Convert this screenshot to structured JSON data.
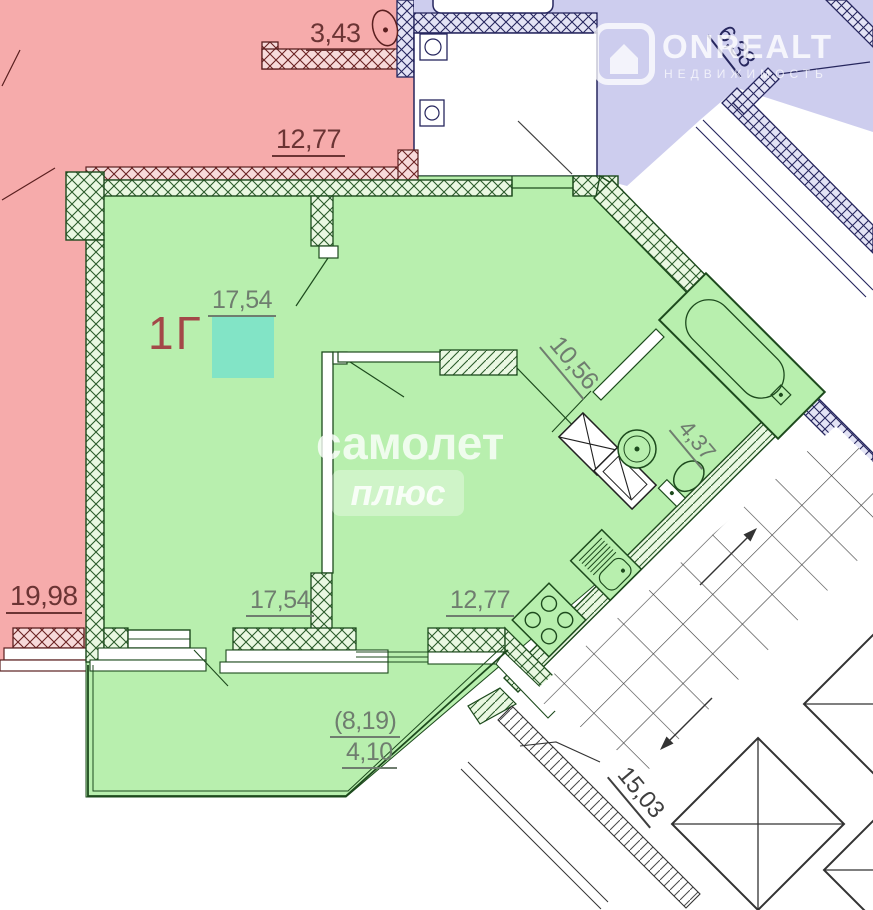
{
  "plan_type": "apartment-floor-plan",
  "unit": {
    "label": "1Г"
  },
  "dimensions": {
    "pink_bath": "3,43",
    "pink_room_top": "12,77",
    "purple_room": "6,38",
    "living_area": "17,54",
    "hallway": "10,56",
    "bathroom": "4,37",
    "pink_room_left": "19,98",
    "living_width": "17,54",
    "kitchen": "12,77",
    "balcony_full": "(8,19)",
    "balcony_reduced": "4,10",
    "stairwell": "15,03"
  },
  "watermarks": {
    "samolet": "самолет",
    "plus": "плюс",
    "onrealt": "ONREALT",
    "onrealt_subtitle": "НЕДВИЖИМОСТЬ"
  },
  "colors": {
    "unit_fill": "#b8efae",
    "neighbor_pink_fill": "#f6abab",
    "neighbor_purple_fill": "#cdcdee",
    "highlight_square": "#7de3c8",
    "dim_green": "#6f7d6f",
    "dim_red": "#6b3434",
    "dim_navy": "#26265e",
    "dim_gray": "#3f3f3f",
    "unit_label_color": "#a34848"
  }
}
